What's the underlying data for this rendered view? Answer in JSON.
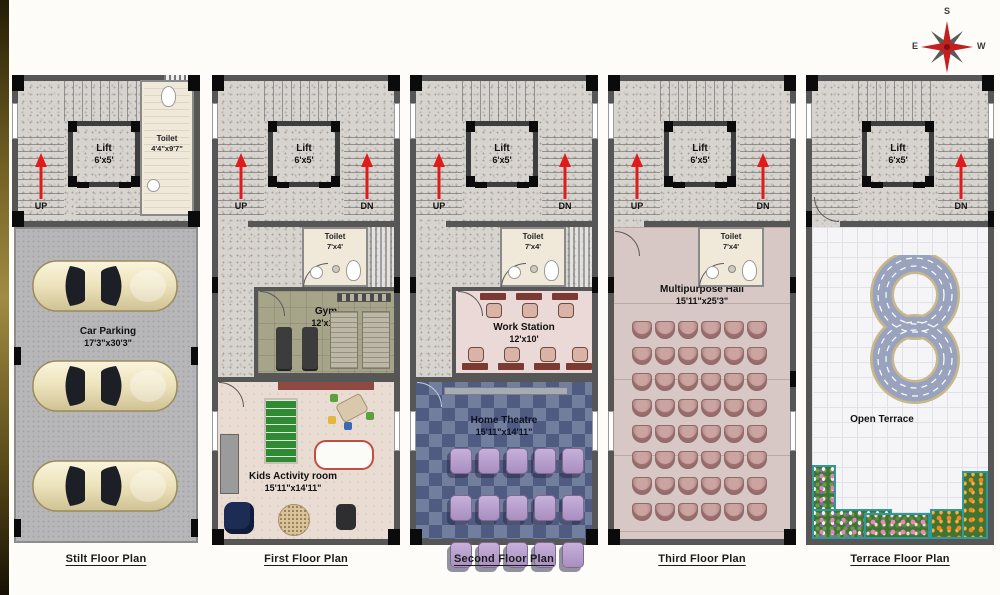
{
  "compass": {
    "top": "S",
    "bottom": "N",
    "left": "E",
    "right": "W"
  },
  "common": {
    "lift": "Lift",
    "lift_size": "6'x5'",
    "up": "UP",
    "dn": "DN",
    "toilet": "Toilet",
    "toilet_size": "7'x4'"
  },
  "floors": [
    {
      "title": "Stilt Floor Plan",
      "toilet": "Toilet",
      "toilet_size": "4'4\"x9'7\"",
      "rooms": [
        {
          "name": "Car Parking",
          "size": "17'3\"x30'3\""
        }
      ]
    },
    {
      "title": "First Floor Plan",
      "rooms": [
        {
          "name": "Gym",
          "size": "12'x10'"
        },
        {
          "name": "Kids Activity room",
          "size": "15'11\"x14'11\""
        }
      ]
    },
    {
      "title": "Second Floor Plan",
      "rooms": [
        {
          "name": "Work Station",
          "size": "12'x10'"
        },
        {
          "name": "Home Theatre",
          "size": "15'11\"x14'11\""
        }
      ]
    },
    {
      "title": "Third Floor Plan",
      "rooms": [
        {
          "name": "Multipurpose Hall",
          "size": "15'11\"x25'3\""
        }
      ]
    },
    {
      "title": "Terrace Floor Plan",
      "rooms": [
        {
          "name": "Open Terrace"
        }
      ]
    }
  ],
  "grids": {
    "hall": "8x6",
    "theatre": "3x5"
  },
  "colors": {
    "arrow_red": "#e01b1b",
    "wall": "#565656",
    "theatre_floor": "#5d6b8f",
    "hall_floor": "#d7c8c6",
    "gym_floor": "#a6a489",
    "compass_red": "#c41e1e"
  }
}
